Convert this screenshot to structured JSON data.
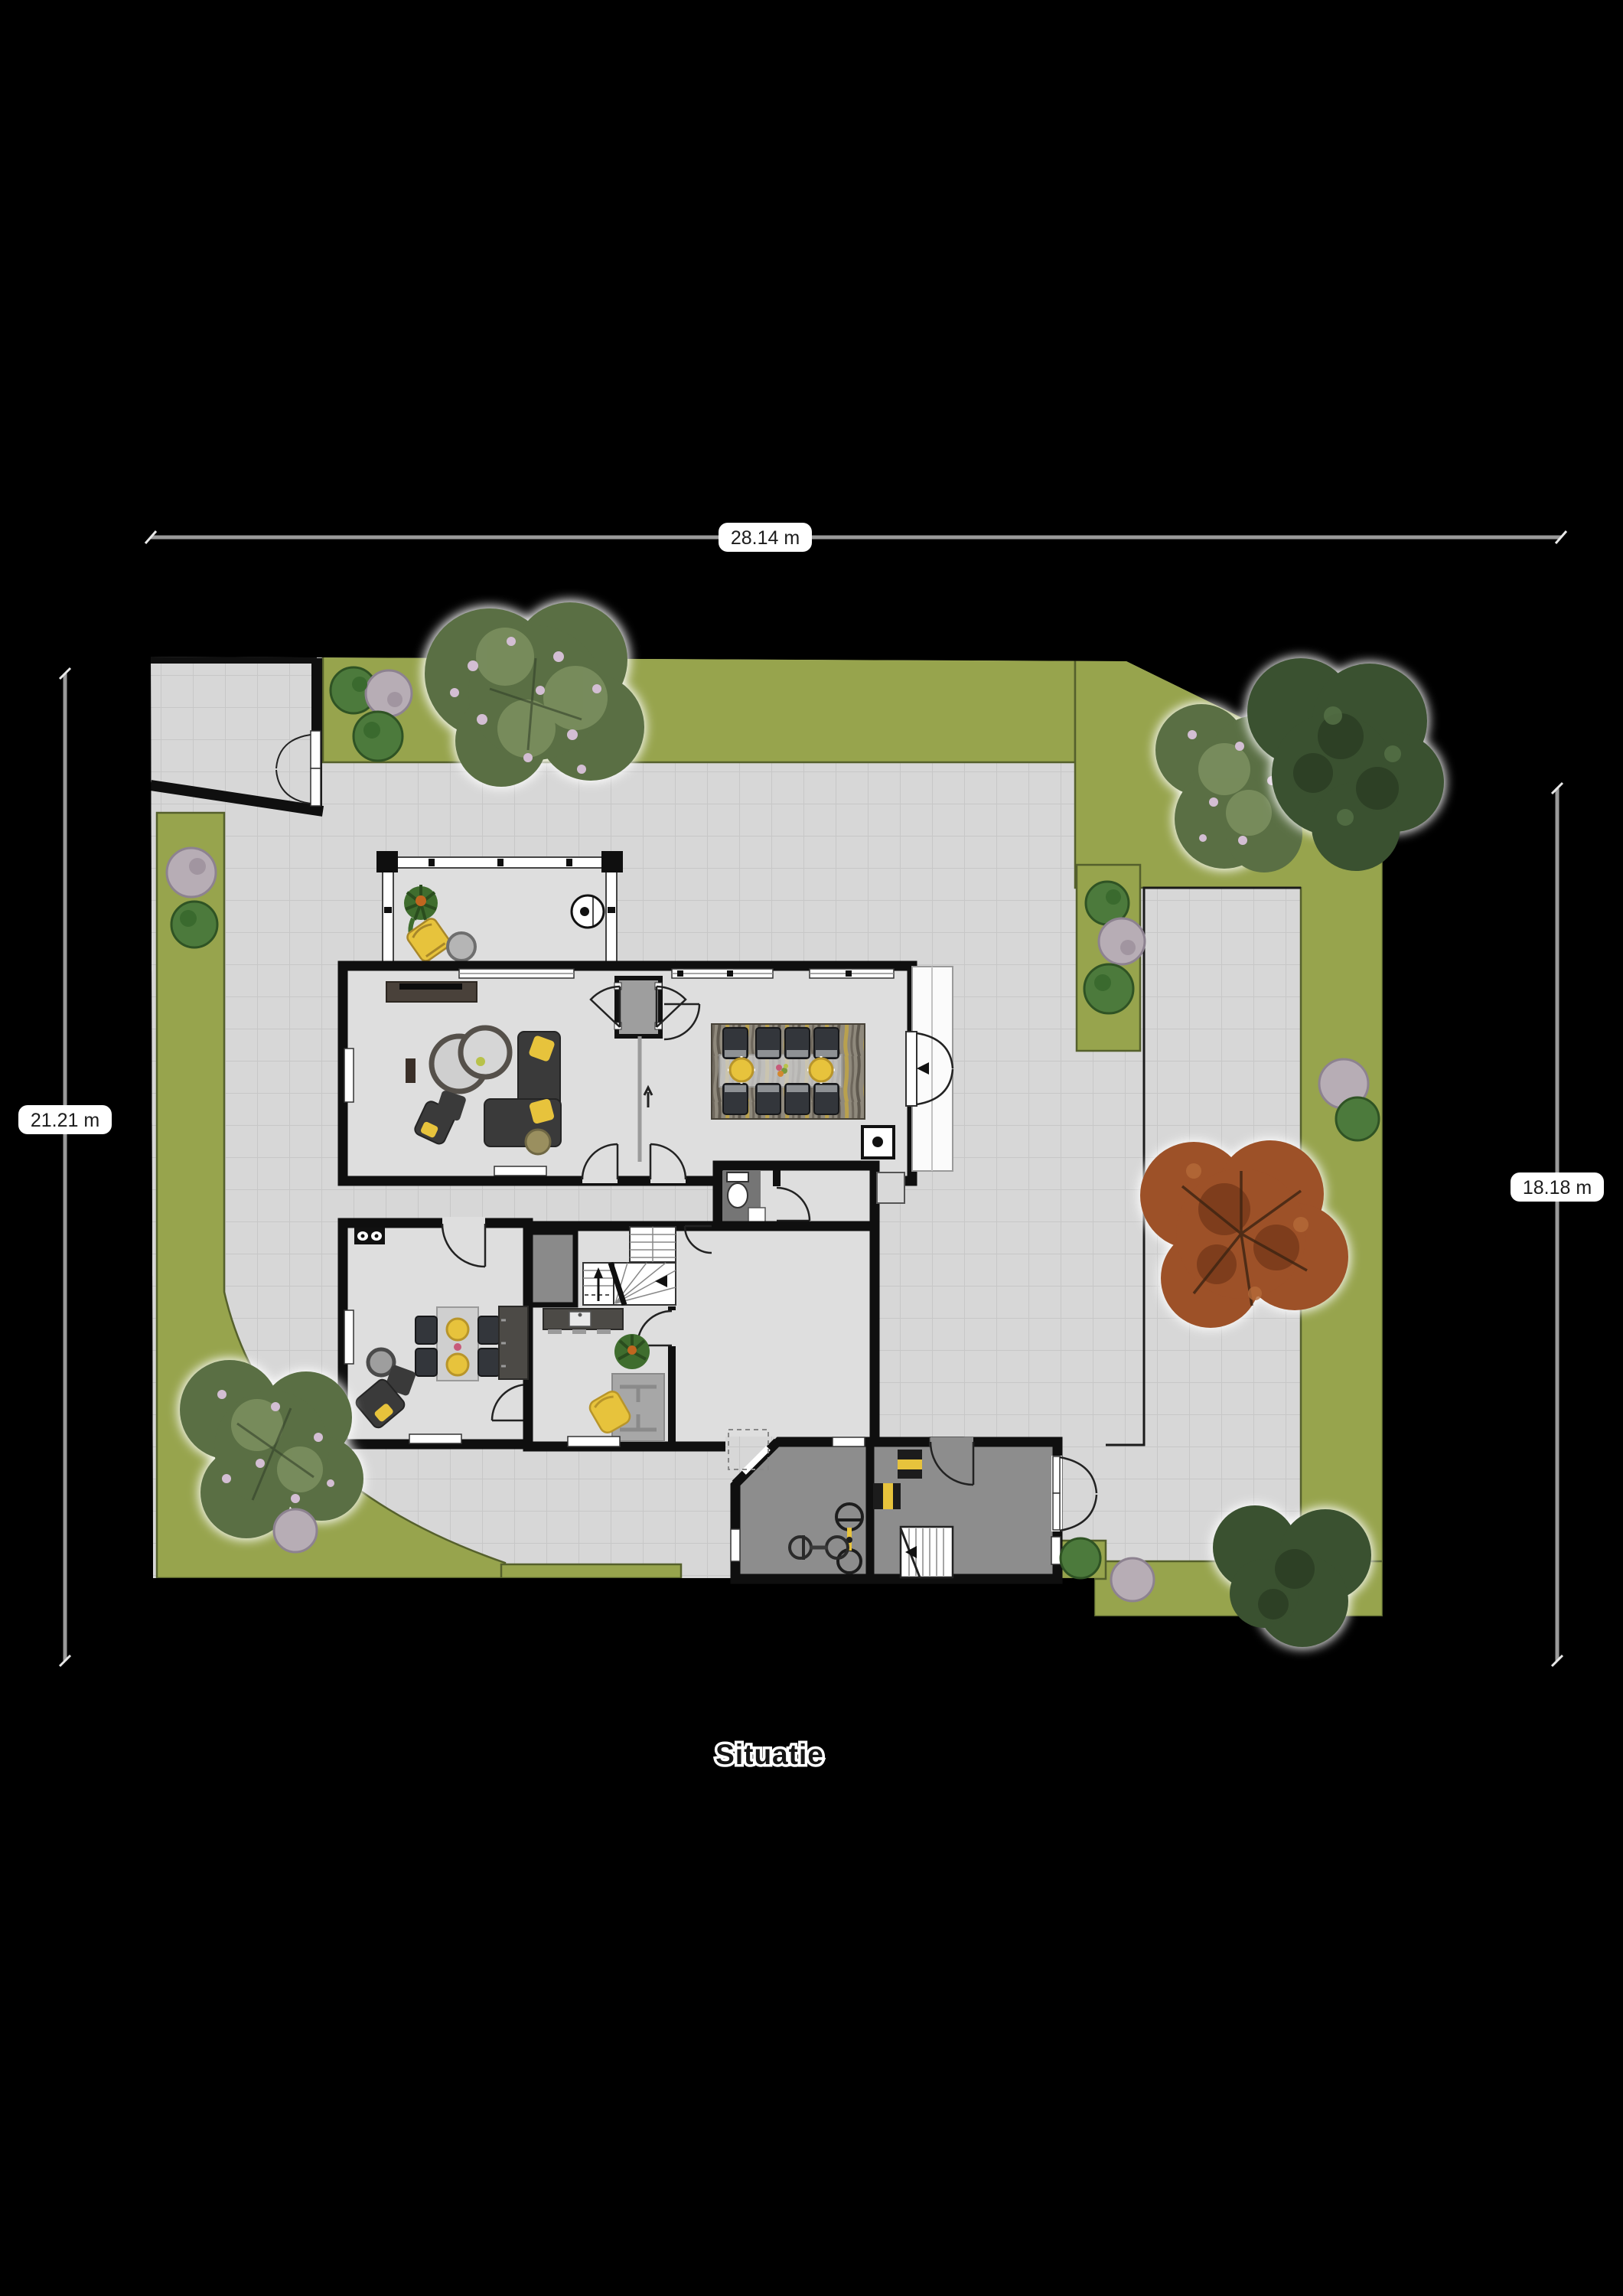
{
  "title": "Situatie",
  "dimensions": {
    "top": "28.14 m",
    "left": "21.21 m",
    "right": "18.18 m"
  },
  "palette": {
    "background": "#000000",
    "paving": "#d7d7d7",
    "paving_grid": "#c7c7c7",
    "grass": "#97a44d",
    "grass_edge": "#55602c",
    "wall": "#0f0f0f",
    "floor": "#dedede",
    "garage_floor": "#8d8d8d",
    "shaft_gray": "#8a8a8a",
    "accent_yellow": "#e7c33c",
    "sofa_dark": "#3a3a3a",
    "wood_dark": "#49413a",
    "counter_slate": "#4c4a46",
    "tree_green": "#5a6f44",
    "tree_dark": "#3a5130",
    "tree_autumn": "#9d5128",
    "bush_green": "#4c7a3c",
    "bush_gray": "#b7adb5",
    "blossom_speckle": "#d3bed3",
    "dimension_line": "#9a9a9a",
    "terrace_white": "#fbfbfb"
  }
}
